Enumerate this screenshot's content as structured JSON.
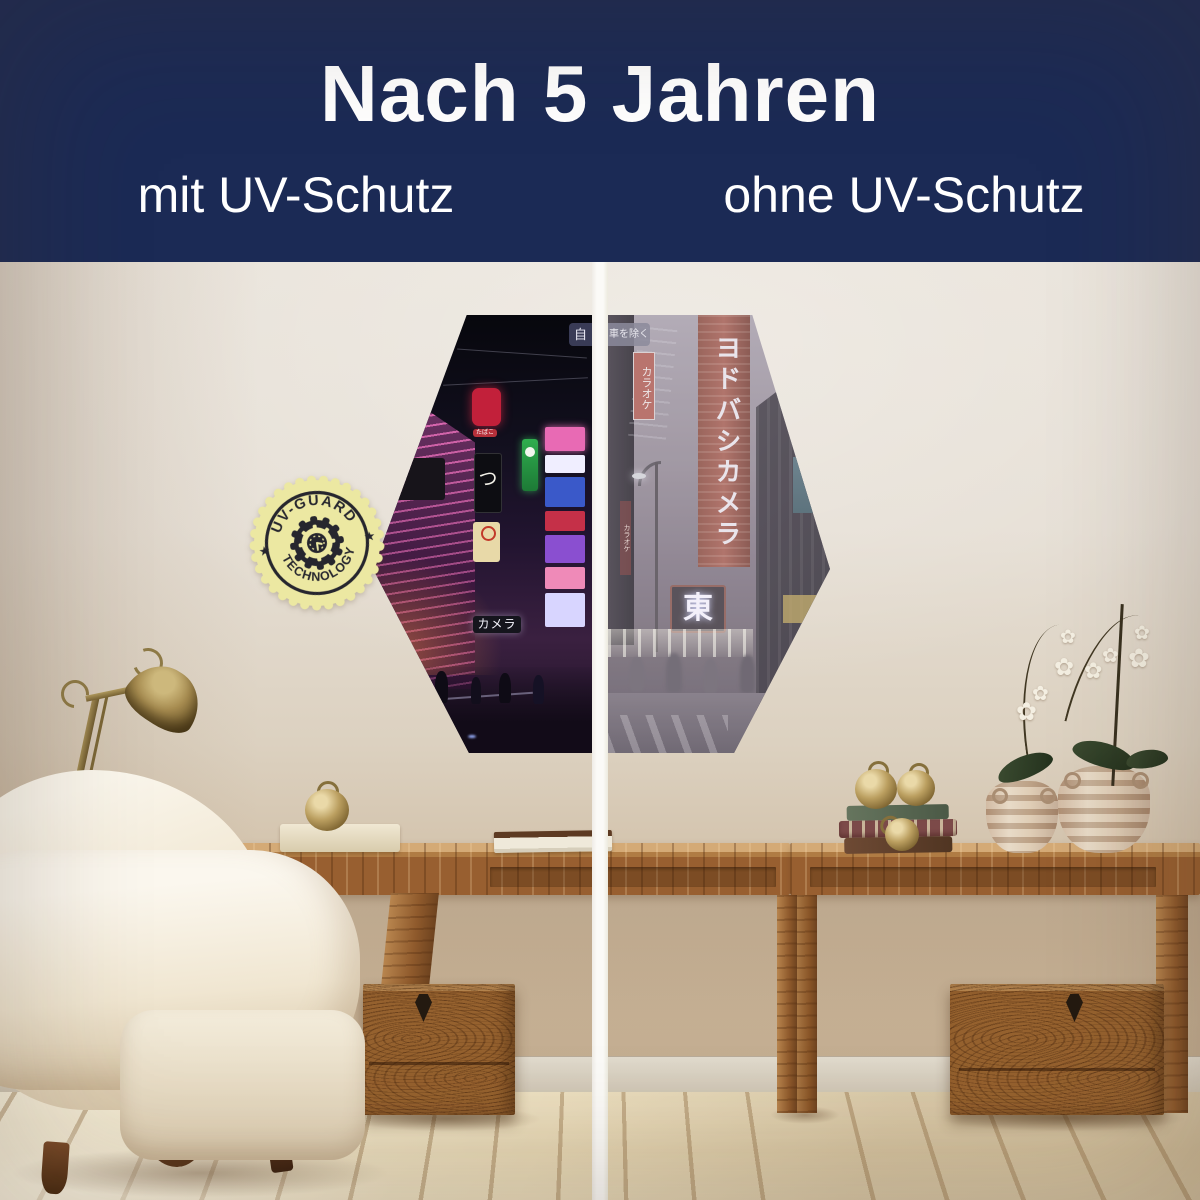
{
  "header": {
    "title": "Nach 5 Jahren",
    "left_label": "mit UV-Schutz",
    "right_label": "ohne UV-Schutz",
    "background_color": "#1b2a55",
    "text_color": "#ffffff"
  },
  "badge": {
    "arc_top": "UV-GUARD",
    "arc_bottom": "TECHNOLOGY",
    "star": "★",
    "fill_color": "#ece8a2",
    "ink_color": "#26262e"
  },
  "artwork": {
    "shape": "hexagon",
    "divider_color": "#f8f6f2",
    "left_panel": {
      "condition": "mit UV-Schutz",
      "style": "vibrant neon night street",
      "signs": {
        "road_sign_fragment": "自",
        "camera_sign": "カメラ",
        "tobacco_sign": "たばこ",
        "brush_sign": "つ"
      }
    },
    "right_panel": {
      "condition": "ohne UV-Schutz",
      "style": "faded washed-out street",
      "signs": {
        "road_sign_fragment": "車を除く",
        "karaoke_sign": "カラオケ",
        "department_store_sign": "ヨドバシカメラ",
        "east_sign": "東",
        "karaoke_column_sign": "カラオケ"
      }
    }
  },
  "scene": {
    "wall_color": "#e7e0d6",
    "floor_color": "#ead9b9",
    "wood_color": "#9a6433",
    "flower_glyph": "✿"
  }
}
